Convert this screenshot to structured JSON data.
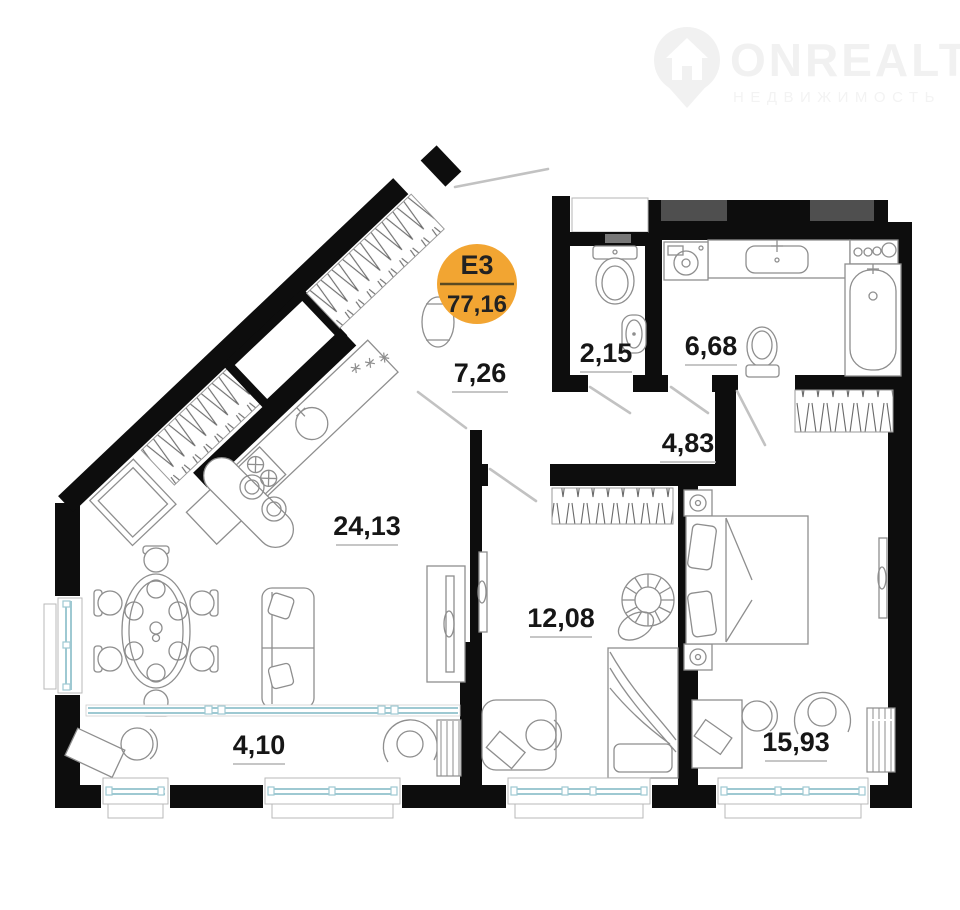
{
  "logo": {
    "brand": "ONREALT",
    "subtitle": "НЕДВИЖИМОСТЬ",
    "icon": "location-pin-house-icon"
  },
  "badge": {
    "unit": "Е3",
    "total_area": "77,16",
    "color": "#F2A532"
  },
  "rooms": [
    {
      "name": "hallway",
      "area": "7,26"
    },
    {
      "name": "wc",
      "area": "2,15"
    },
    {
      "name": "bathroom",
      "area": "6,68"
    },
    {
      "name": "inner-hall",
      "area": "4,83"
    },
    {
      "name": "kitchen-living-room",
      "area": "24,13"
    },
    {
      "name": "room",
      "area": "12,08"
    },
    {
      "name": "bedroom",
      "area": "15,93"
    },
    {
      "name": "balcony",
      "area": "4,10"
    }
  ],
  "colors": {
    "walls": "#0d0d0d",
    "windows": "#9ec9d2",
    "furniture_outline": "#8e8e8e",
    "ventilation_shaft": "#4f4f4f",
    "label_text": "#161616",
    "badge": "#F2A532"
  }
}
